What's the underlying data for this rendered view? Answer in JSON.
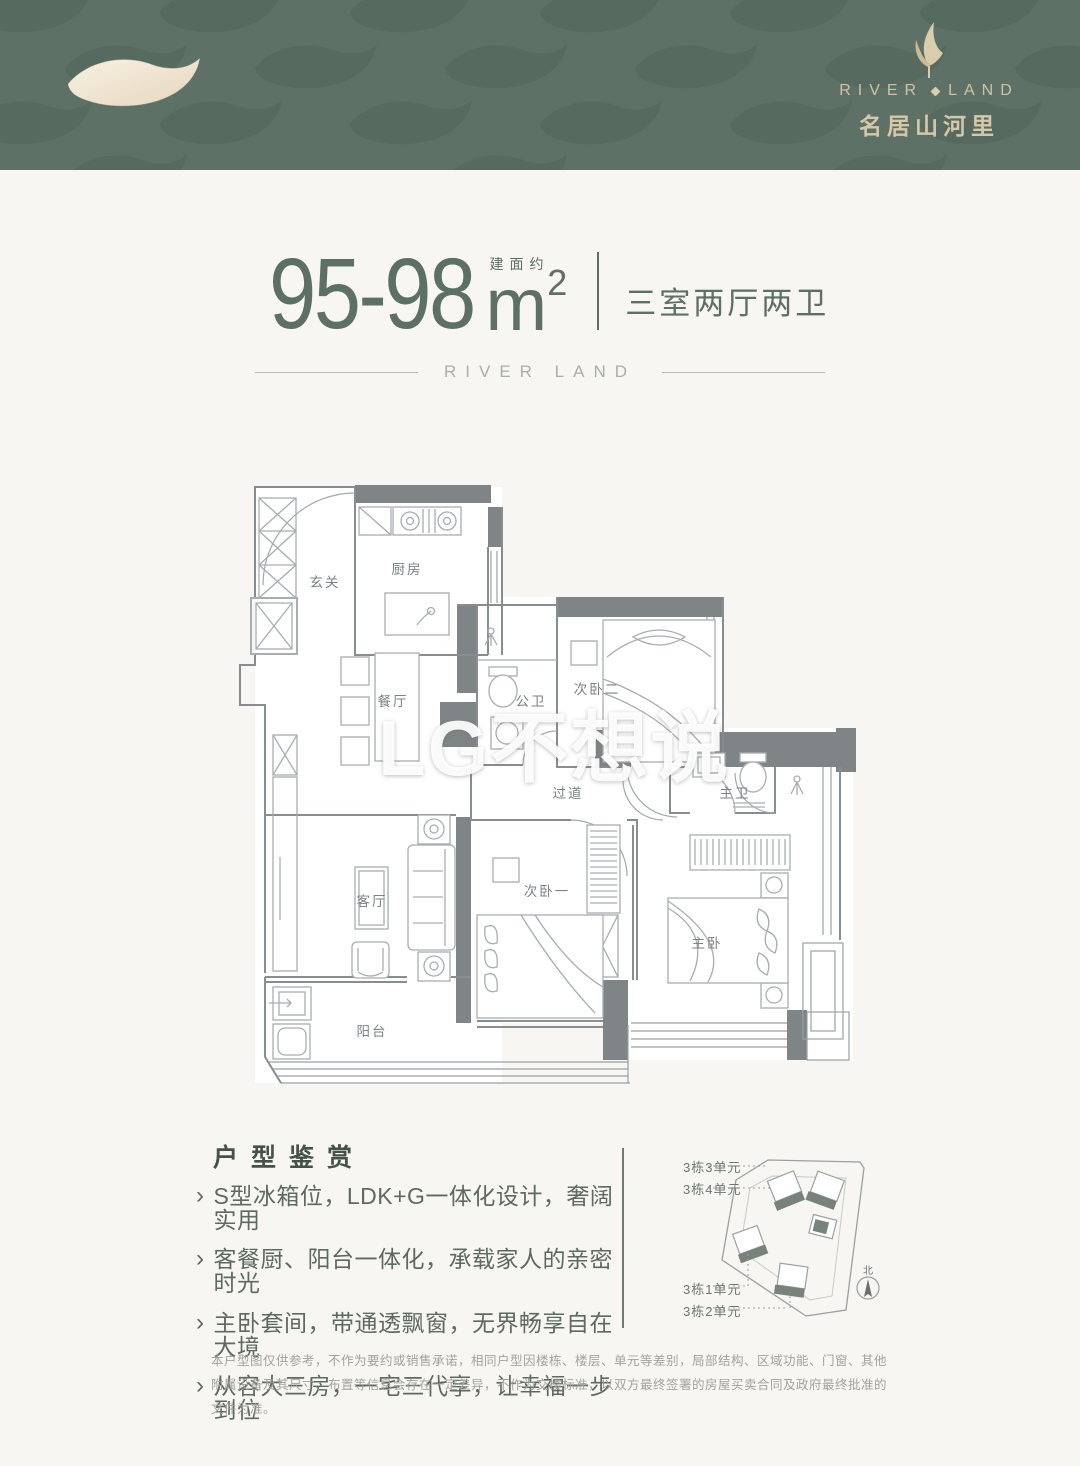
{
  "colors": {
    "banner_green": "#5d7166",
    "banner_wave_dark": "#536459",
    "banner_wave_cream": "#f2e9d8",
    "logo_cream": "#d5c8a8",
    "title_green": "#5c7065",
    "feature_text": "#5d6a62",
    "plan_wall_gray": "#7f8486",
    "plan_line_gray": "#9aa0a3",
    "disclaimer_gray": "#a2a29e"
  },
  "header": {
    "brand_en_left": "RIVER",
    "brand_en_right": "LAND",
    "brand_cn": "名居山河里"
  },
  "title": {
    "area_range": "95-98",
    "area_note": "建面约",
    "unit": "m",
    "unit_sup": "2",
    "layout_type": "三室两厅两卫",
    "brand_divider": "RIVER LAND"
  },
  "floorplan": {
    "watermark": "LG不想说",
    "rooms": [
      {
        "label": "玄关"
      },
      {
        "label": "厨房"
      },
      {
        "label": "餐厅"
      },
      {
        "label": "公卫"
      },
      {
        "label": "次卧二"
      },
      {
        "label": "过道"
      },
      {
        "label": "主卫"
      },
      {
        "label": "客厅"
      },
      {
        "label": "次卧一"
      },
      {
        "label": "主卧"
      },
      {
        "label": "阳台"
      }
    ]
  },
  "features": {
    "heading": "户型鉴赏",
    "bullet_glyph": "›",
    "items": [
      "S型冰箱位，LDK+G一体化设计，奢阔实用",
      "客餐厨、阳台一体化，承载家人的亲密时光",
      "主卧套间，带通透飘窗，无界畅享自在大境",
      "从容大三房，一宅三代享，让幸福一步到位"
    ]
  },
  "siteplan": {
    "building_labels": [
      "3栋3单元",
      "3栋4单元",
      "3栋1单元",
      "3栋2单元"
    ],
    "compass_label": "北"
  },
  "disclaimer": "本户型图仅供参考，不作为要约或销售承诺，相同户型因楼栋、楼层、单元等差别，局部结构、区域功能、门窗、其他附属设备及其尺寸、布置等信息会存在一定差异，不作为交楼标准，以双方最终签署的房屋买卖合同及政府最终批准的文件为准。"
}
